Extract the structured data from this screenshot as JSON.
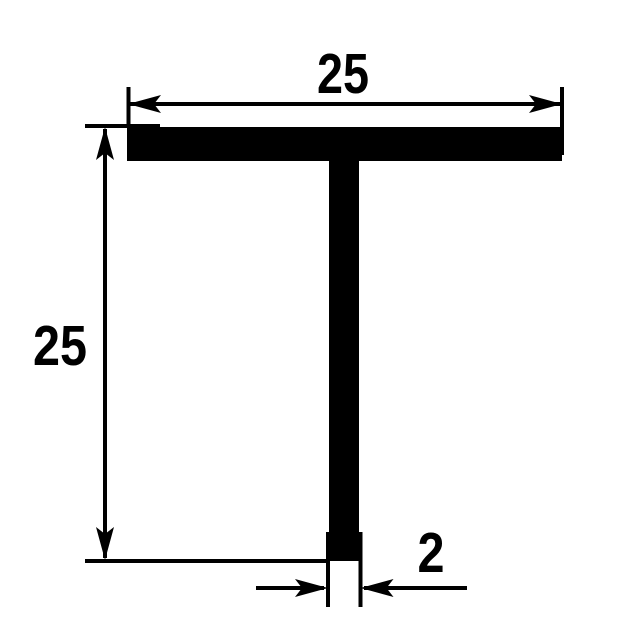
{
  "drawing": {
    "subject": "T-profile cross-section technical drawing",
    "profile_shape": "T",
    "colors": {
      "ink": "#000000",
      "background": "#ffffff"
    },
    "dimensions": {
      "width": {
        "label": "25",
        "position": "top"
      },
      "height": {
        "label": "25",
        "position": "left"
      },
      "thickness": {
        "label": "2",
        "position": "bottom-right"
      }
    }
  }
}
